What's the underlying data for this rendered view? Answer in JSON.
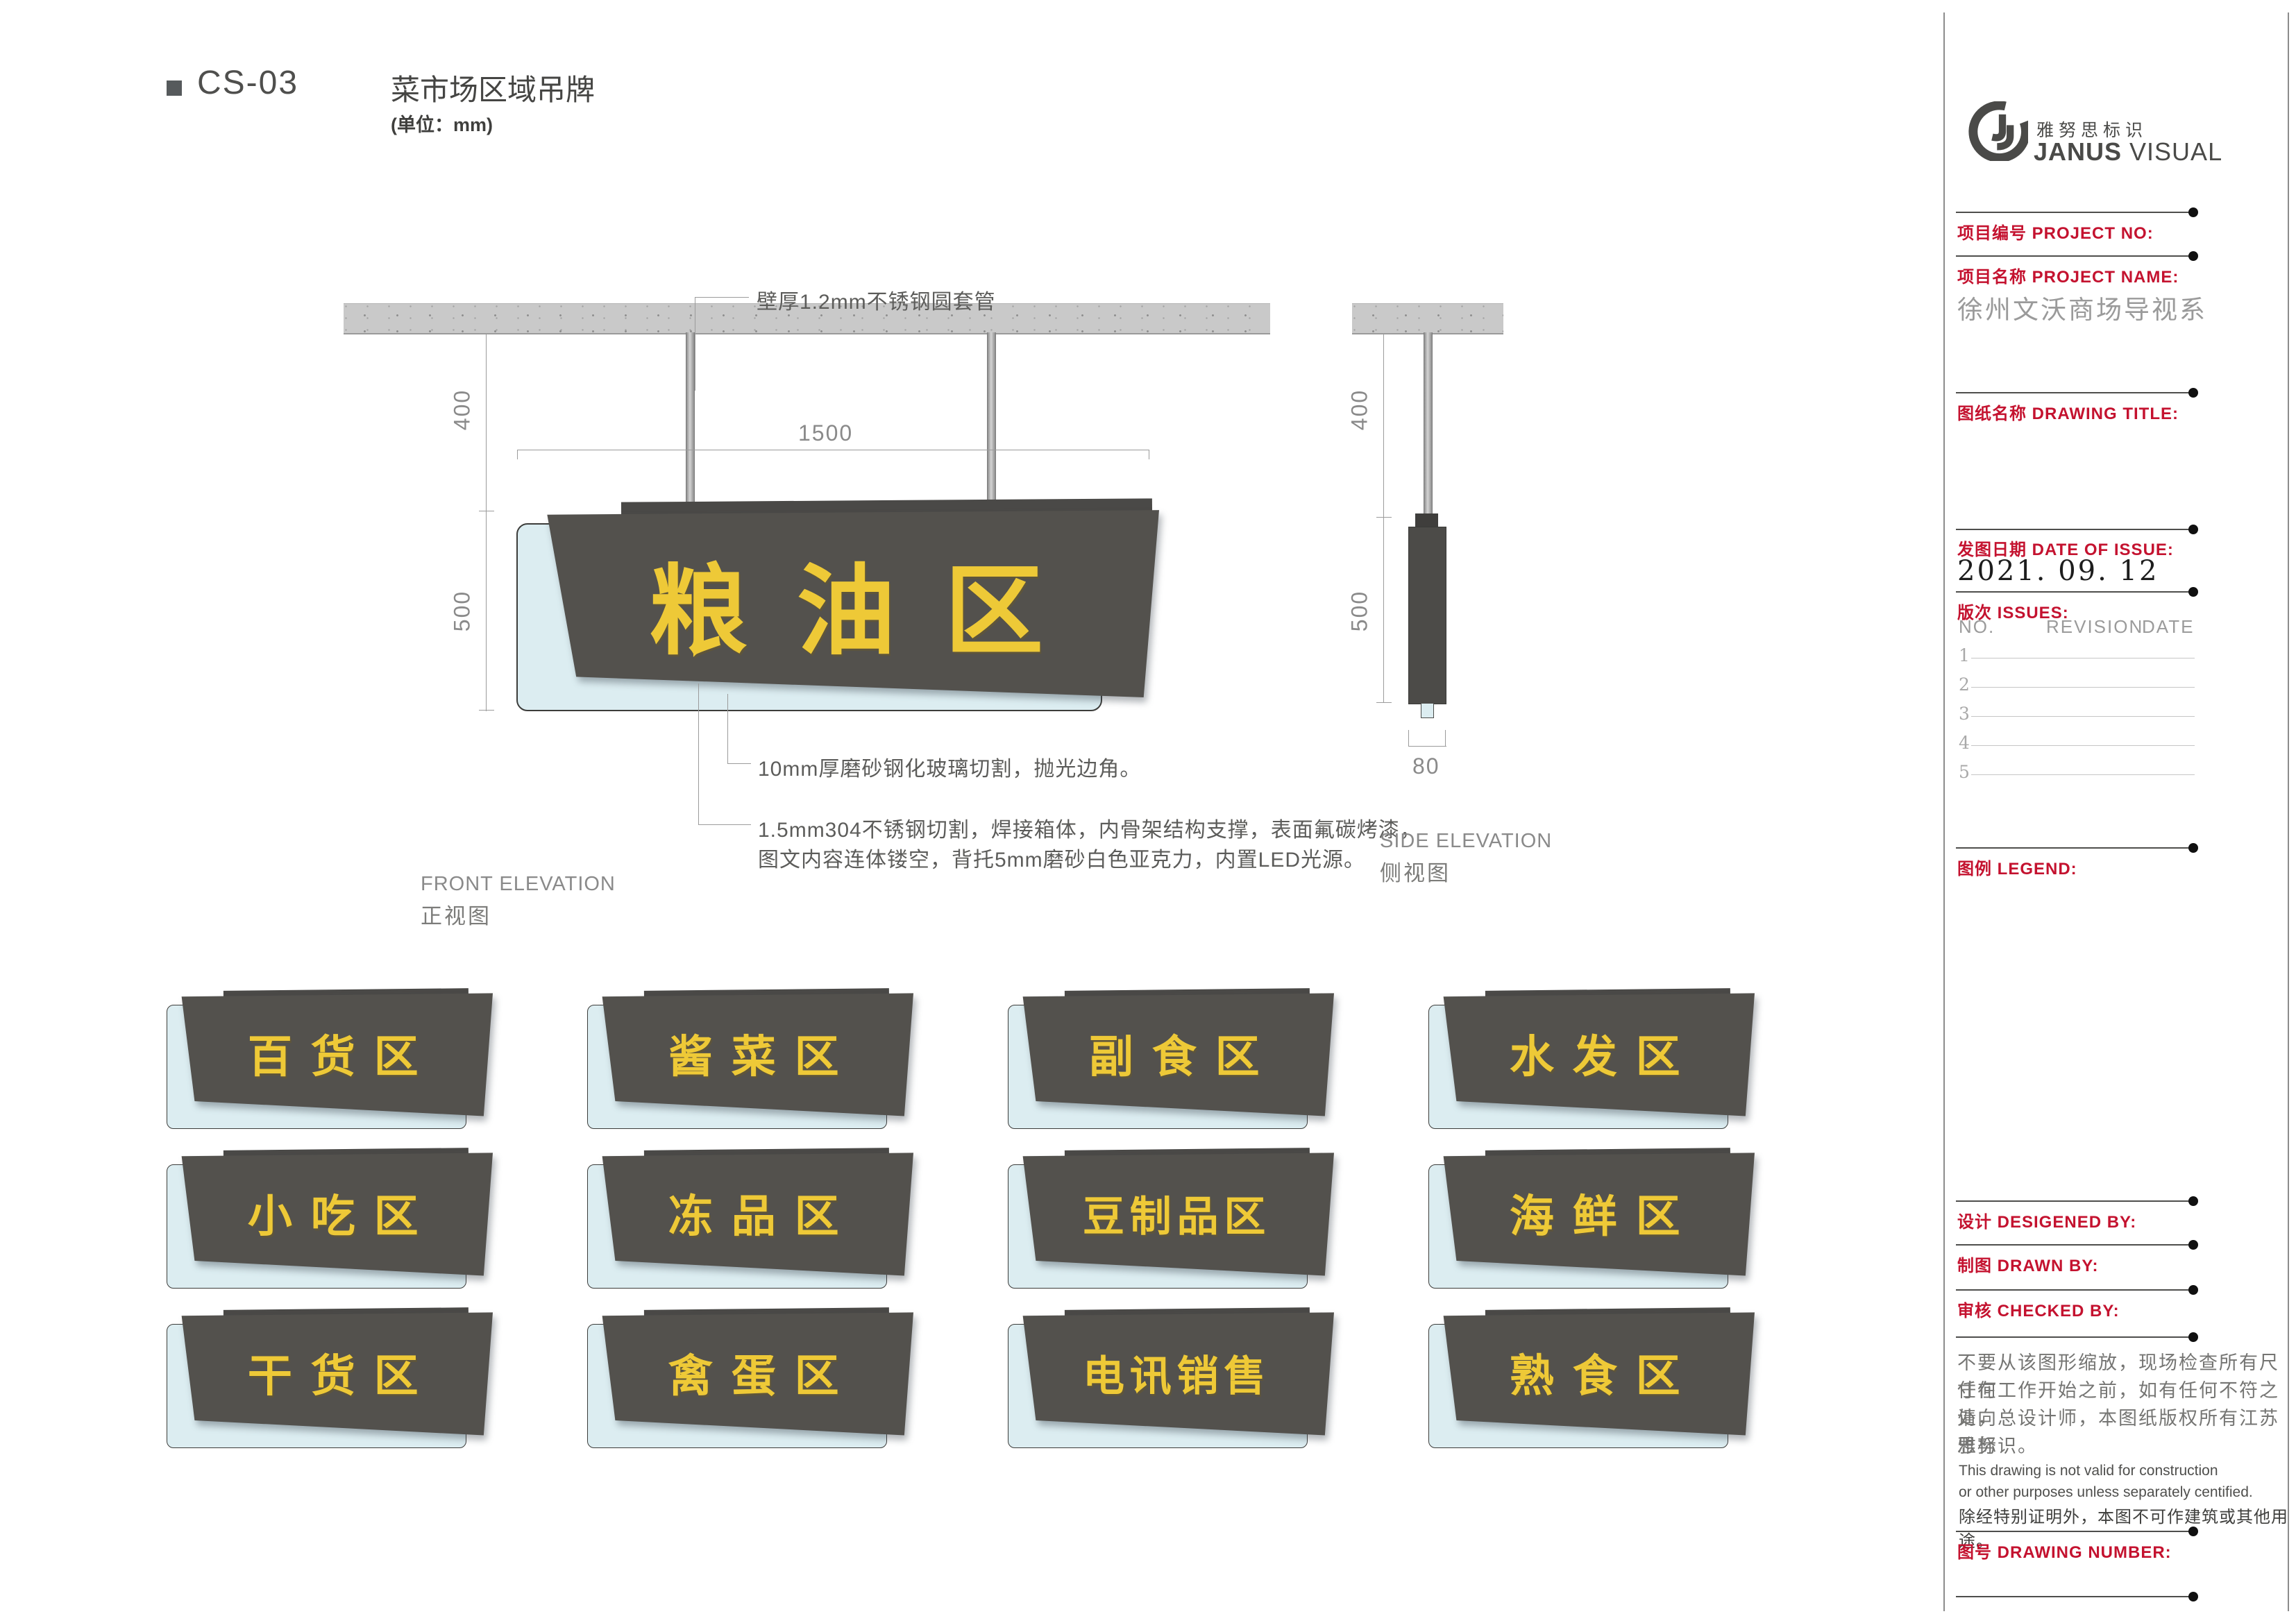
{
  "page": {
    "code": "CS-03",
    "title": "菜市场区域吊牌",
    "unit_note": "(单位：mm)"
  },
  "front_elevation": {
    "callout_pipe": "壁厚1.2mm不锈钢圆套管",
    "dim_drop": "400",
    "dim_width": "1500",
    "dim_height": "500",
    "main_sign_text": "粮油区",
    "note_glass": "10mm厚磨砂钢化玻璃切割，抛光边角。",
    "note_steel_line1": "1.5mm304不锈钢切割，焊接箱体，内骨架结构支撑，表面氟碳烤漆，",
    "note_steel_line2": "图文内容连体镂空，背托5mm磨砂白色亚克力，内置LED光源。",
    "label_en": "FRONT ELEVATION",
    "label_cn": "正视图"
  },
  "side_elevation": {
    "dim_drop": "400",
    "dim_height": "500",
    "dim_depth": "80",
    "label_en": "SIDE ELEVATION",
    "label_cn": "侧视图"
  },
  "signs": [
    "百货区",
    "酱菜区",
    "副食区",
    "水发区",
    "小吃区",
    "冻品区",
    "豆制品区",
    "海鲜区",
    "干货区",
    "禽蛋区",
    "电讯销售",
    "熟食区"
  ],
  "titleblock": {
    "logo_cn": "雅努思标识",
    "logo_en_bold": "JANUS",
    "logo_en_light": " VISUAL",
    "project_no_label": "项目编号  PROJECT NO:",
    "project_name_label": "项目名称  PROJECT NAME:",
    "project_name_value": "徐州文沃商场导视系",
    "drawing_title_label": "图纸名称  DRAWING TITLE:",
    "date_label": "发图日期  DATE OF ISSUE:",
    "date_value": "2021. 09. 12",
    "issues_label": "版次  ISSUES:",
    "issues_cols": [
      "NO.",
      "REVISION",
      "DATE"
    ],
    "issue_rows": [
      "1",
      "2",
      "3",
      "4",
      "5"
    ],
    "legend_label": "图例  LEGEND:",
    "designed_label": "设计  DESIGENED BY:",
    "drawn_label": "制图  DRAWN BY:",
    "checked_label": "审核  CHECKED BY:",
    "disclaimer_cn": [
      "不要从该图形缩放，现场检查所有尺寸在",
      "任何工作开始之前，如有任何不符之处，",
      "请向总设计师，本图纸版权所有江苏雅努",
      "思标识。"
    ],
    "disclaimer_en": [
      "This drawing is not valid for construction",
      "or other purposes unless separately centified."
    ],
    "disclaimer_cn2": "除经特别证明外，本图不可作建筑或其他用途。",
    "drawing_number_label": "图号  DRAWING NUMBER:"
  },
  "colors": {
    "accent_red": "#c4122f",
    "sign_yellow": "#eec937",
    "sign_panel": "#53514d",
    "sign_glass": "#dcedf1",
    "ceiling_gray": "#c9c9c9"
  }
}
